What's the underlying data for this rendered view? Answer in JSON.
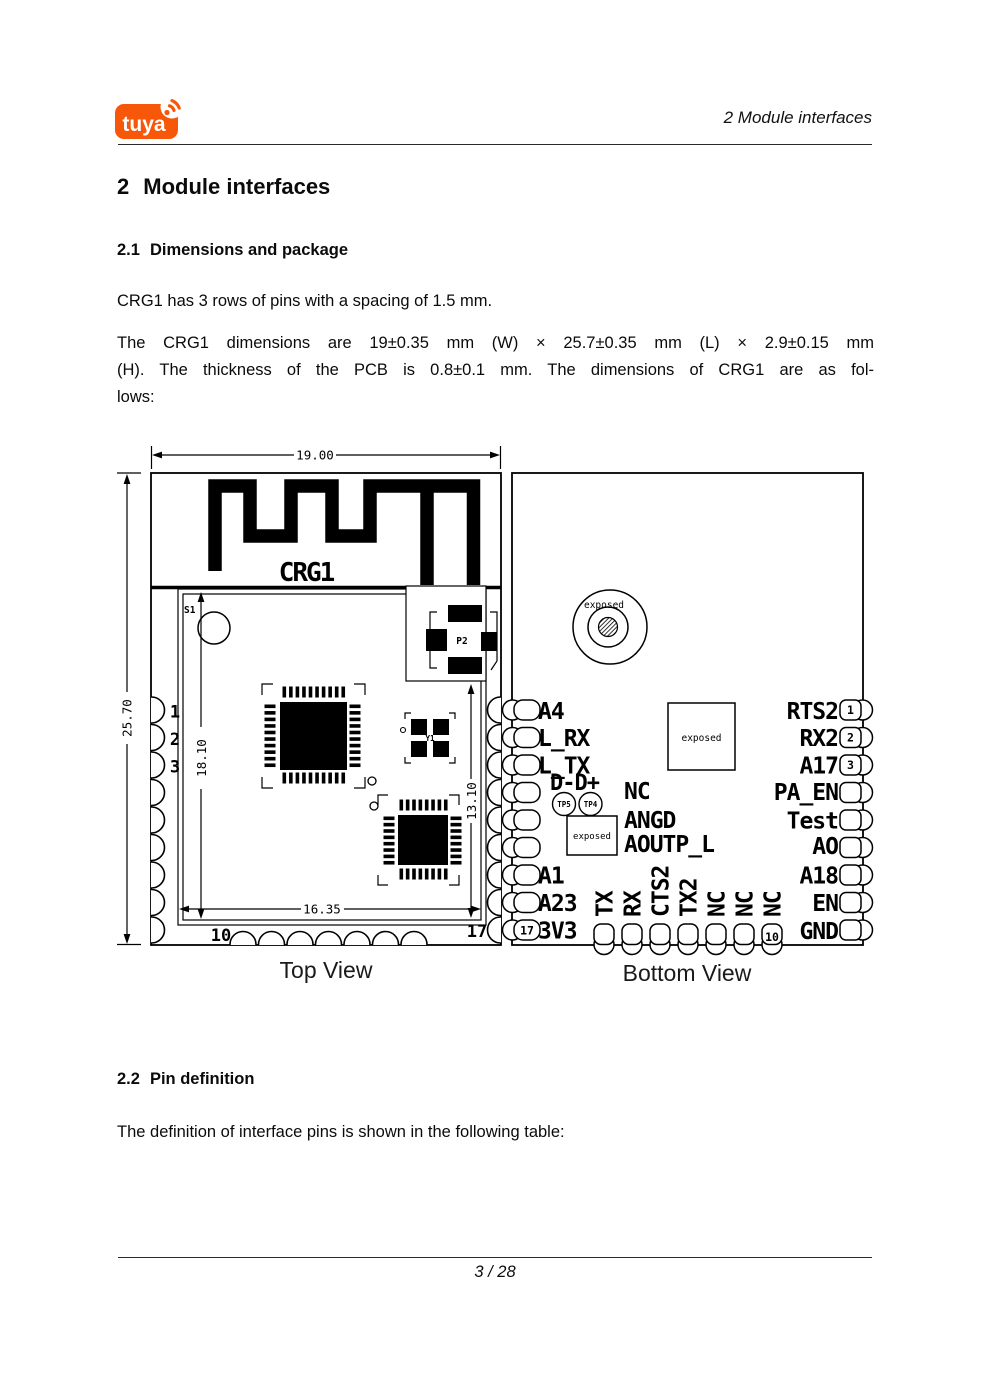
{
  "header": {
    "logo_text": "tuya",
    "running_title": "2  Module interfaces"
  },
  "body": {
    "h1_num": "2",
    "h1_text": "Module interfaces",
    "s21_num": "2.1",
    "s21_title": "Dimensions and package",
    "s21_p1": "CRG1 has 3 rows of pins with a spacing of 1.5 mm.",
    "s21_p2_lines": [
      "The CRG1 dimensions are 19±0.35 mm (W) × 25.7±0.35 mm (L) × 2.9±0.15 mm",
      "(H). The thickness of the PCB is 0.8±0.1 mm. The dimensions of CRG1 are as fol-",
      "lows:"
    ],
    "s22_num": "2.2",
    "s22_title": "Pin definition",
    "s22_p1": "The definition of interface pins is shown in the following table:"
  },
  "footer": {
    "page_number": "3 / 28"
  },
  "figure": {
    "top_view": {
      "caption": "Top View",
      "silkscreen": "CRG1",
      "dim_width": "19.00",
      "dim_height": "25.70",
      "dim_inner_height": "18.10",
      "dim_inner_width": "16.35",
      "dim_inner_right": "13.10",
      "ref_s1": "S1",
      "ref_p2": "P2",
      "ref_y1": "Y1",
      "pin1": "1",
      "pin2": "2",
      "pin3": "3",
      "pin10": "10",
      "pin17": "17"
    },
    "bottom_view": {
      "caption": "Bottom View",
      "exposed_label": "exposed",
      "tp5": "TP5",
      "tp4": "TP4",
      "dd_label": "D-D+",
      "left_pins": [
        "A4",
        "L_RX",
        "L_TX",
        "A1",
        "A23",
        "3V3"
      ],
      "center_pins": [
        "NC",
        "ANGD",
        "AOUTP_L"
      ],
      "right_pins": [
        "RTS2",
        "RX2",
        "A17",
        "PA_EN",
        "Test",
        "AO",
        "A18",
        "EN",
        "GND"
      ],
      "bottom_pins": [
        "TX",
        "RX",
        "CTS2",
        "TX2",
        "NC",
        "NC",
        "NC"
      ],
      "num1": "1",
      "num2": "2",
      "num3": "3",
      "num10": "10",
      "num17": "17"
    }
  },
  "colors": {
    "brand_orange": "#F75708",
    "ink": "#000000"
  }
}
